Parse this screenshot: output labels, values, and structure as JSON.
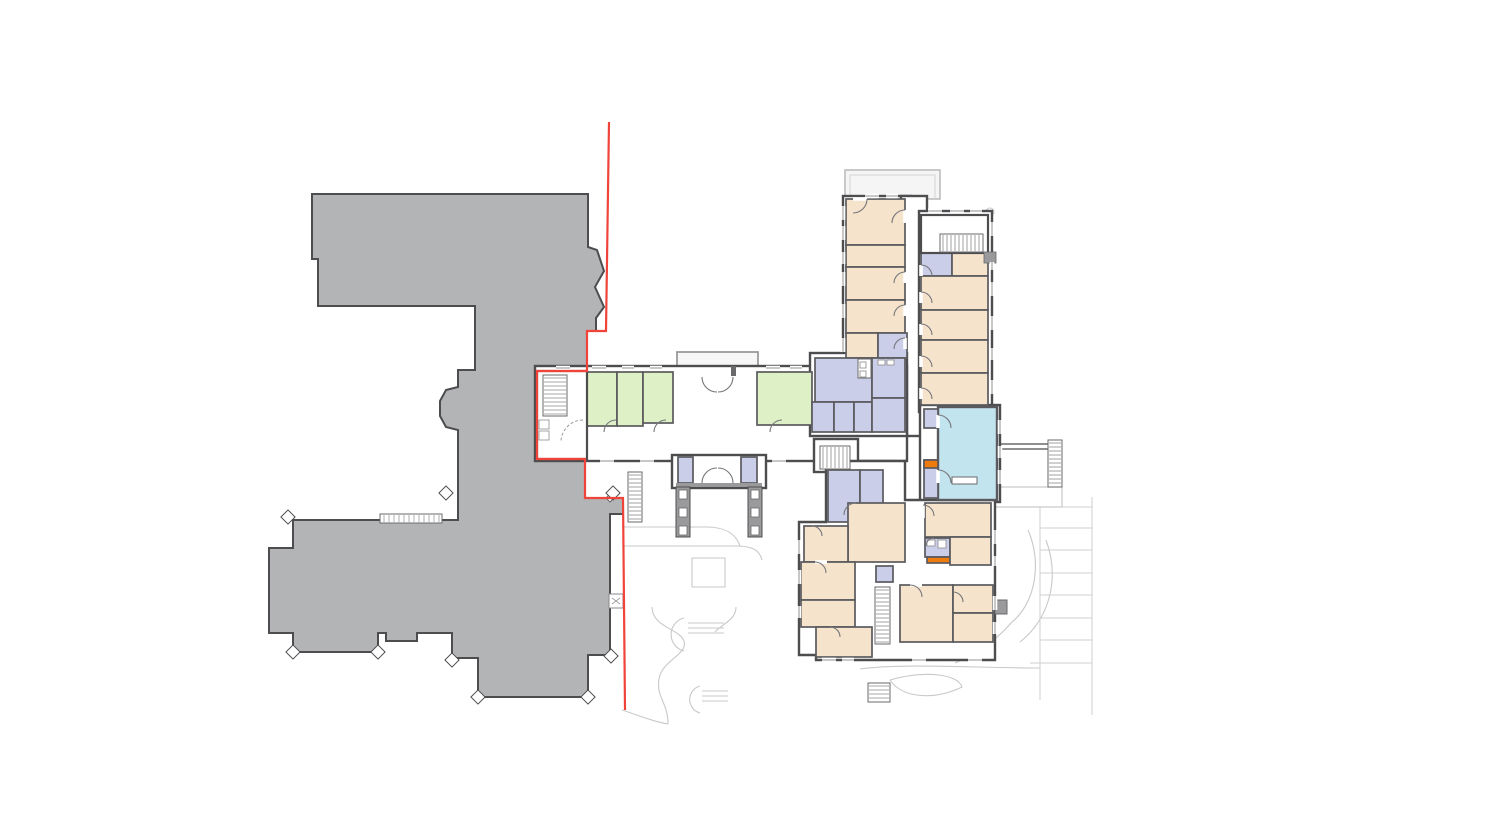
{
  "document": {
    "type": "architectural-floor-plan",
    "description": "Ground floor plan: grey existing mansion massing, red site boundary line, new care-home wings with colour-coded rooms, light grey landscape context"
  },
  "legend": {
    "existing_building": "#b3b4b6",
    "existing_outline": "#4d4d4f",
    "bedroom": "#f5e3cc",
    "communal": "#def0c5",
    "service": "#cbcee8",
    "lounge": "#c2e4ee",
    "highlight": "#ee7b0e",
    "wall": "#4d4d4f",
    "partition": "#5a5a5e",
    "site_line": "#c9c9c9",
    "terrace_fill": "#f5f5f5",
    "boundary_red": "#f0433a",
    "background": "#ffffff"
  },
  "canvas": {
    "width": 1500,
    "height": 833
  },
  "existing_building": {
    "outline_points": "312,194 588,194 588,247 597,250 604,271 595,287 604,307 596,318 596,331 587,331 587,371 537,371 537,459 585,459 585,498 623,498 623,514 610,514 610,655 588,655 588,697 478,697 478,658 452,658 452,633 417,633 417,641 386,641 386,633 378,633 378,652 293,652 293,633 269,633 269,548 293,548 293,520 458,520 458,430 446,427 440,416 440,401 446,390 458,387 458,370 475,370 475,306 318,306 318,259 312,259",
    "diamond_markers": [
      [
        288,
        517
      ],
      [
        446,
        493
      ],
      [
        613,
        493
      ],
      [
        293,
        652
      ],
      [
        378,
        652
      ],
      [
        452,
        660
      ],
      [
        478,
        697
      ],
      [
        588,
        697
      ],
      [
        611,
        656
      ]
    ],
    "steps_rect": [
      380,
      514,
      62,
      9
    ],
    "x_box": [
      609,
      594,
      14,
      14
    ],
    "corner_door_leaf": "M606,498 l9,-9 l4,4 l-9,9 z"
  },
  "boundary": {
    "points": "609,122 606,331 587,331 587,371 537,371 537,459 585,459 585,498 623,498 625,710"
  },
  "blocks": [
    [
      843,
      196,
      68,
      166
    ],
    [
      901,
      196,
      26,
      240
    ],
    [
      919,
      211,
      73,
      201
    ],
    [
      920,
      405,
      80,
      97
    ],
    [
      535,
      366,
      372,
      95
    ],
    [
      810,
      353,
      97,
      83
    ],
    [
      814,
      439,
      44,
      33
    ],
    [
      672,
      455,
      94,
      33
    ]
  ],
  "south_wing_poly": "826,461 905,461 905,500 995,500 995,660 816,660 816,655 799,655 799,522 826,522",
  "rooms": [
    {
      "c": "bedroom",
      "r": [
        846,
        199,
        59,
        46
      ]
    },
    {
      "c": "bedroom",
      "r": [
        846,
        245,
        59,
        22
      ]
    },
    {
      "c": "bedroom",
      "r": [
        846,
        267,
        59,
        33
      ]
    },
    {
      "c": "bedroom",
      "r": [
        846,
        300,
        59,
        33
      ]
    },
    {
      "c": "bedroom",
      "r": [
        846,
        333,
        32,
        25
      ]
    },
    {
      "c": "service",
      "r": [
        878,
        333,
        29,
        25
      ]
    },
    {
      "c": "service",
      "r": [
        921,
        253,
        31,
        23
      ]
    },
    {
      "c": "bedroom",
      "r": [
        952,
        253,
        36,
        23
      ]
    },
    {
      "c": "bedroom",
      "r": [
        921,
        276,
        67,
        34
      ]
    },
    {
      "c": "bedroom",
      "r": [
        921,
        310,
        67,
        30
      ]
    },
    {
      "c": "bedroom",
      "r": [
        921,
        340,
        67,
        33
      ]
    },
    {
      "c": "bedroom",
      "r": [
        921,
        373,
        67,
        32
      ]
    },
    {
      "c": "communal",
      "r": [
        586,
        372,
        31,
        54
      ]
    },
    {
      "c": "communal",
      "r": [
        617,
        372,
        26,
        54
      ]
    },
    {
      "c": "communal",
      "r": [
        643,
        372,
        30,
        51
      ]
    },
    {
      "c": "communal",
      "r": [
        757,
        372,
        55,
        53
      ]
    },
    {
      "c": "service",
      "r": [
        815,
        358,
        57,
        44
      ]
    },
    {
      "c": "service",
      "r": [
        872,
        358,
        33,
        40
      ]
    },
    {
      "c": "service",
      "r": [
        812,
        402,
        22,
        30
      ]
    },
    {
      "c": "service",
      "r": [
        834,
        402,
        20,
        30
      ]
    },
    {
      "c": "service",
      "r": [
        854,
        402,
        18,
        30
      ]
    },
    {
      "c": "service",
      "r": [
        872,
        398,
        33,
        34
      ]
    },
    {
      "c": "service",
      "r": [
        678,
        457,
        15,
        26
      ]
    },
    {
      "c": "service",
      "r": [
        741,
        457,
        16,
        26
      ]
    },
    {
      "c": "service",
      "r": [
        828,
        470,
        32,
        52
      ]
    },
    {
      "c": "service",
      "r": [
        860,
        470,
        23,
        52
      ]
    },
    {
      "c": "lounge",
      "r": [
        938,
        407,
        59,
        93
      ]
    },
    {
      "c": "service",
      "r": [
        924,
        409,
        14,
        19
      ]
    },
    {
      "c": "service",
      "r": [
        924,
        460,
        14,
        38
      ]
    },
    {
      "c": "highlight",
      "r": [
        924,
        460,
        14,
        8
      ]
    },
    {
      "c": "bedroom",
      "r": [
        848,
        503,
        57,
        59
      ]
    },
    {
      "c": "bedroom",
      "r": [
        925,
        503,
        66,
        34
      ]
    },
    {
      "c": "service",
      "r": [
        925,
        538,
        25,
        19
      ]
    },
    {
      "c": "highlight",
      "r": [
        927,
        557,
        23,
        6
      ]
    },
    {
      "c": "bedroom",
      "r": [
        950,
        537,
        41,
        28
      ]
    },
    {
      "c": "bedroom",
      "r": [
        804,
        526,
        44,
        36
      ]
    },
    {
      "c": "bedroom",
      "r": [
        801,
        562,
        54,
        38
      ]
    },
    {
      "c": "bedroom",
      "r": [
        801,
        600,
        54,
        27
      ]
    },
    {
      "c": "bedroom",
      "r": [
        816,
        627,
        56,
        30
      ]
    },
    {
      "c": "service",
      "r": [
        876,
        566,
        17,
        16
      ]
    },
    {
      "c": "bedroom",
      "r": [
        900,
        585,
        53,
        57
      ]
    },
    {
      "c": "bedroom",
      "r": [
        953,
        585,
        40,
        28
      ]
    },
    {
      "c": "bedroom",
      "r": [
        953,
        613,
        40,
        29
      ]
    }
  ],
  "white_rooms": [
    [
      537,
      371,
      50,
      88
    ],
    [
      921,
      215,
      67,
      38
    ]
  ],
  "stairs": [
    {
      "r": [
        543,
        375,
        24,
        41
      ],
      "dir": "h"
    },
    {
      "r": [
        940,
        234,
        43,
        18
      ],
      "dir": "v"
    },
    {
      "r": [
        820,
        446,
        30,
        23
      ],
      "dir": "v"
    },
    {
      "r": [
        875,
        587,
        15,
        57
      ],
      "dir": "h"
    },
    {
      "r": [
        1048,
        440,
        14,
        47
      ],
      "dir": "h"
    },
    {
      "r": [
        628,
        472,
        14,
        50
      ],
      "dir": "h"
    },
    {
      "r": [
        868,
        683,
        22,
        19
      ],
      "dir": "h"
    }
  ],
  "windows": [
    [
      843,
      206,
      843,
      220
    ],
    [
      843,
      226,
      843,
      240
    ],
    [
      843,
      252,
      843,
      264
    ],
    [
      843,
      272,
      843,
      286
    ],
    [
      843,
      304,
      843,
      318
    ],
    [
      843,
      338,
      843,
      352
    ],
    [
      992,
      222,
      992,
      236
    ],
    [
      992,
      262,
      992,
      270
    ],
    [
      992,
      282,
      992,
      296
    ],
    [
      992,
      316,
      992,
      330
    ],
    [
      992,
      348,
      992,
      360
    ],
    [
      992,
      380,
      992,
      394
    ],
    [
      556,
      368,
      570,
      368
    ],
    [
      592,
      368,
      606,
      368
    ],
    [
      622,
      368,
      634,
      368
    ],
    [
      650,
      368,
      662,
      368
    ],
    [
      766,
      368,
      780,
      368
    ],
    [
      790,
      368,
      802,
      368
    ],
    [
      600,
      461,
      614,
      461
    ],
    [
      640,
      461,
      654,
      461
    ],
    [
      772,
      461,
      786,
      461
    ],
    [
      799,
      540,
      799,
      554
    ],
    [
      799,
      570,
      799,
      584
    ],
    [
      799,
      606,
      799,
      618
    ],
    [
      822,
      660,
      836,
      660
    ],
    [
      842,
      660,
      854,
      660
    ],
    [
      912,
      660,
      926,
      660
    ],
    [
      968,
      660,
      982,
      660
    ],
    [
      995,
      530,
      995,
      544
    ],
    [
      995,
      556,
      995,
      566
    ],
    [
      995,
      596,
      995,
      610
    ],
    [
      995,
      622,
      995,
      634
    ],
    [
      1000,
      420,
      1000,
      434
    ],
    [
      1000,
      446,
      1000,
      458
    ],
    [
      1000,
      470,
      1000,
      484
    ],
    [
      865,
      196,
      879,
      196
    ],
    [
      886,
      196,
      898,
      196
    ],
    [
      928,
      211,
      942,
      211
    ],
    [
      950,
      211,
      964,
      211
    ],
    [
      970,
      211,
      982,
      211
    ]
  ],
  "door_gaps": [
    [
      905,
      210,
      905,
      223
    ],
    [
      905,
      272,
      905,
      283
    ],
    [
      905,
      305,
      905,
      316
    ],
    [
      905,
      338,
      905,
      349
    ],
    [
      921,
      265,
      921,
      276
    ],
    [
      921,
      292,
      921,
      303
    ],
    [
      921,
      324,
      921,
      335
    ],
    [
      921,
      356,
      921,
      367
    ],
    [
      921,
      388,
      921,
      399
    ],
    [
      938,
      415,
      938,
      428
    ],
    [
      938,
      470,
      938,
      483
    ],
    [
      604,
      432,
      616,
      432
    ],
    [
      654,
      432,
      666,
      432
    ],
    [
      770,
      432,
      782,
      432
    ],
    [
      853,
      199,
      867,
      199
    ],
    [
      923,
      505,
      923,
      518
    ],
    [
      910,
      585,
      922,
      585
    ],
    [
      815,
      562,
      827,
      562
    ]
  ],
  "doors": [
    "M905,210 a13,13 0 0 0 -13,13",
    "M905,272 a11,11 0 0 0 -11,11",
    "M905,305 a11,11 0 0 0 -11,11",
    "M905,338 a11,11 0 0 0 -11,11",
    "M867,199 a14,14 0 0 1 -14,14",
    "M921,265 a11,11 0 0 1 11,11",
    "M921,292 a11,11 0 0 1 11,11",
    "M921,324 a11,11 0 0 1 11,11",
    "M921,356 a11,11 0 0 1 11,11",
    "M921,388 a11,11 0 0 1 11,11",
    "M938,415 a13,13 0 0 1 13,13",
    "M938,470 a13,13 0 0 1 13,13",
    "M604,432 a12,12 0 0 1 12,-12",
    "M654,432 a12,12 0 0 1 12,-12",
    "M770,432 a12,12 0 0 1 12,-12",
    "M702,377 a15,15 0 0 0 15,15",
    "M733,377 a15,15 0 0 1 -15,15",
    "M702,483 a15,15 0 0 1 15,-15",
    "M733,483 a15,15 0 0 0 -15,-15",
    "M856,503 a12,12 0 0 0 -12,12",
    "M923,505 a11,11 0 0 1 11,11",
    "M910,585 a12,12 0 0 1 12,12",
    "M953,592 a10,10 0 0 1 10,10",
    "M815,562 a11,11 0 0 1 11,11",
    "M830,627 a10,10 0 0 1 10,10",
    "M812,526 a10,10 0 0 1 10,10",
    "M934,538 a8,8 0 0 0 -8,8"
  ],
  "dashed_doors": [
    "M583,420 a22,22 0 0 0 -22,22"
  ],
  "porches": {
    "north_terrace": [
      845,
      170,
      95,
      29
    ],
    "north_porch": [
      677,
      352,
      81,
      16
    ],
    "south_porch": {
      "left_pillar": [
        676,
        487,
        14,
        50
      ],
      "right_pillar": [
        748,
        487,
        14,
        50
      ],
      "pillar_squares_y": [
        490,
        508,
        526
      ],
      "rail": [
        676,
        483,
        86,
        4
      ]
    },
    "east_platform": [
      990,
      487,
      72,
      20
    ],
    "se_step": [
      995,
      600,
      12,
      14
    ]
  },
  "site": {
    "paths": [
      "M692,558 h33 v29 h-33 z",
      "M652,607 C652,627 680,629 684,641 C688,655 662,660 659,679 C656,698 668,702 668,724",
      "M736,607 C736,620 722,624 715,632",
      "M684,618 A17,17 0 0 0 684,651",
      "M688,623 H724 M688,628 H724 M688,633 H724",
      "M700,686 A14,14 0 0 0 700,713",
      "M702,691 H728 M702,696 H728 M702,701 H728",
      "M890,680 C925,670 958,674 962,687 C935,700 903,699 890,680",
      "M622,527 H706 C726,527 736,534 740,546",
      "M622,546 H736 C755,546 760,552 762,560",
      "M1028,530 C1042,562 1036,602 1012,622",
      "M1046,540 C1060,578 1050,618 1020,642",
      "M1012,622 C992,645 972,656 955,663",
      "M860,669 C905,663 975,668 1040,668",
      "M622,710 C640,716 655,722 668,724",
      "M907,643 h23 v12 h-23 z",
      "M967,643 h23 v12 h-23 z",
      "M986,212 a4,4 0 1 0 8,0 a4,4 0 1 0 -8,0"
    ],
    "parking_lines": [
      "M1012,507 H1092",
      "M1040,507 V700",
      "M1092,497 V715",
      "M1040,528 H1092",
      "M1040,550 H1092",
      "M1040,573 H1092",
      "M1040,595 H1092",
      "M1040,618 H1092",
      "M1040,640 H1092",
      "M1030,663 H1092"
    ],
    "dark_details": [
      "M998,444 H1048",
      "M998,449 H1048"
    ]
  },
  "fixtures": {
    "lounge_table": [
      952,
      477,
      25,
      7
    ],
    "kitchen_unit": [
      858,
      359,
      13,
      19
    ],
    "kitchen_squares": [
      [
        860,
        362,
        6,
        6
      ],
      [
        860,
        371,
        6,
        6
      ],
      [
        878,
        360,
        7,
        5
      ],
      [
        887,
        360,
        7,
        5
      ]
    ],
    "stair_room_closets": [
      [
        539,
        420,
        10,
        9
      ],
      [
        539,
        431,
        10,
        9
      ]
    ],
    "porch_tick": [
      731,
      366,
      5,
      10
    ],
    "bath_fixtures": [
      [
        927,
        540,
        8,
        6
      ],
      [
        938,
        540,
        8,
        8
      ]
    ],
    "pilaster": [
      984,
      252,
      12,
      11
    ]
  }
}
